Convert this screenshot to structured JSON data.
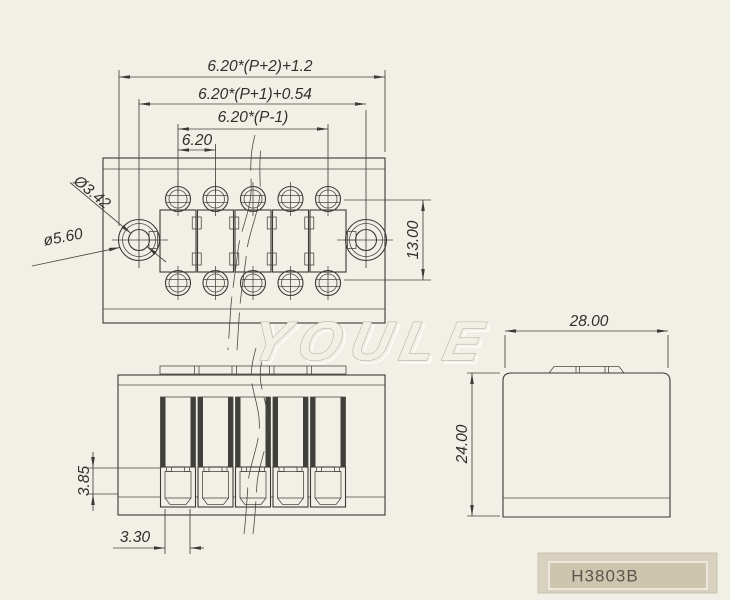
{
  "background_color": "#f2efe6",
  "line_color": "#3a3a38",
  "top_view": {
    "dim_total_width": "6.20*(P+2)+1.2",
    "dim_mounting_span": "6.20*(P+1)+0.54",
    "dim_pole_span": "6.20*(P-1)",
    "dim_pitch": "6.20",
    "dim_screw_dia": "Ø3.42",
    "dim_mount_hole_dia": "ø5.60",
    "dim_row_spacing": "13.00"
  },
  "front_view": {
    "dim_contact_height": "3.85",
    "dim_contact_width": "3.30"
  },
  "side_view": {
    "dim_depth": "28.00",
    "dim_height": "24.00"
  },
  "watermark": {
    "text": "YOULE",
    "stroke_color": "#b5b1a2",
    "highlight_color": "#ffffff"
  },
  "part_plate": {
    "label": "H3803B",
    "outer_color": "#d8d1bf",
    "inner_color": "#cdc5ae",
    "border_color": "#ebe7da",
    "text_color": "#5a564c"
  }
}
